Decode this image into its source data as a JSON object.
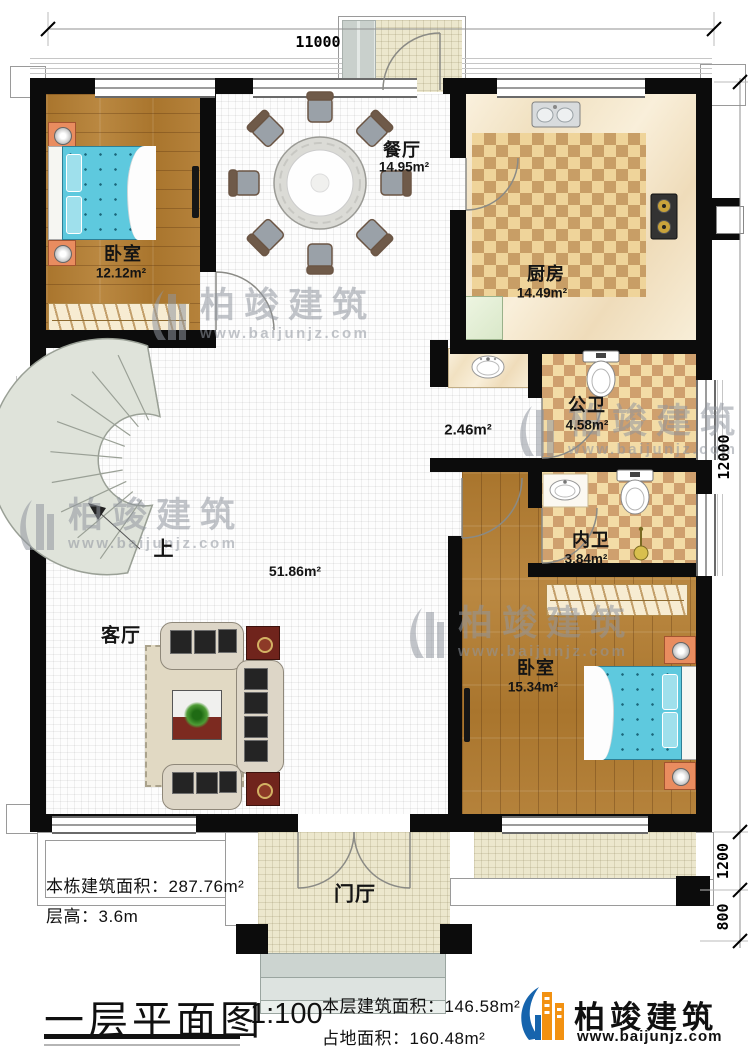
{
  "dimensions": {
    "top": "11000",
    "right_total": "12000",
    "right_porch": "1200",
    "right_steps": "800"
  },
  "rooms": {
    "bedroom1": {
      "name": "卧室",
      "area": "12.12m²"
    },
    "dining": {
      "name": "餐厅",
      "area": "14.95m²"
    },
    "kitchen": {
      "name": "厨房",
      "area": "14.49m²"
    },
    "hallway": {
      "area": "2.46m²"
    },
    "bath_public": {
      "name": "公卫",
      "area": "4.58m²"
    },
    "bath_ensuite": {
      "name": "内卫",
      "area": "3.84m²"
    },
    "bedroom2": {
      "name": "卧室",
      "area": "15.34m²"
    },
    "living": {
      "name": "客厅",
      "area": "51.86m²"
    },
    "foyer": {
      "name": "门厅"
    },
    "stairs": {
      "direction": "上"
    }
  },
  "annotations": {
    "building_total_area": "本栋建筑面积：287.76m²",
    "floor_height": "层高：3.6m"
  },
  "title_block": {
    "title": "一层平面图",
    "scale": "1:100",
    "floor_area": "本层建筑面积：146.58m²",
    "footprint_area": "占地面积：160.48m²"
  },
  "brand": {
    "name": "柏竣建筑",
    "url": "www.baijunjz.com"
  },
  "watermark": {
    "name": "柏竣建筑",
    "url": "www.baijunjz.com"
  }
}
